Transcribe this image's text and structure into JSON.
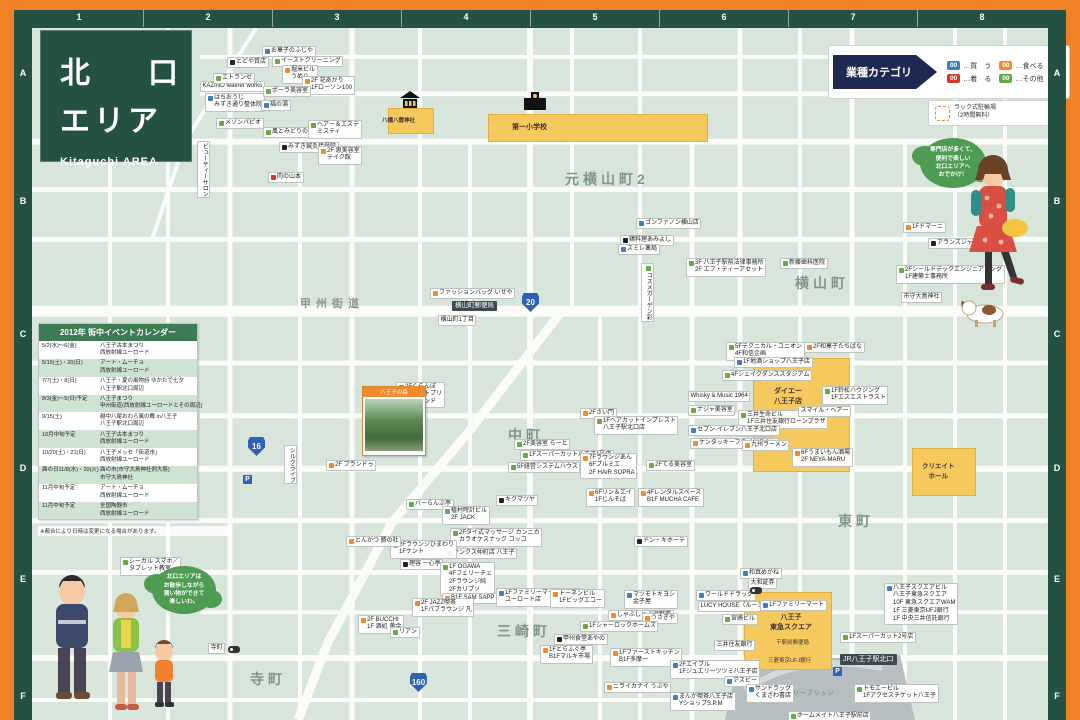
{
  "frame": {
    "columns": [
      "1",
      "2",
      "3",
      "4",
      "5",
      "6",
      "7",
      "8"
    ],
    "rows": [
      "A",
      "B",
      "C",
      "D",
      "E",
      "F"
    ]
  },
  "title": {
    "line1": "北　口",
    "line2": "エリア",
    "subtitle": "Kitaguchi AREA"
  },
  "legend": {
    "header": "業種カテゴリ",
    "items": [
      {
        "code": "00",
        "label": "…買　う",
        "color": "#3f7fc1"
      },
      {
        "code": "00",
        "label": "…食べる",
        "color": "#ef8a2e"
      },
      {
        "code": "00",
        "label": "…着　る",
        "color": "#cf3b2a"
      },
      {
        "code": "00",
        "label": "…その他",
        "color": "#67a944"
      }
    ],
    "parking_label": "ラック式駐輪場\n（2時間無料）"
  },
  "calendar": {
    "title": "2012年 街中イベントカレンダー",
    "rows": [
      {
        "d": "5/2(水)～6(金)",
        "e": "八王子古本まつり\n西放射線ユーロード"
      },
      {
        "d": "5/19(土)・20(日)",
        "e": "アート・ムーチョ\n西放射線ユーロード"
      },
      {
        "d": "7/7(土)・8(日)",
        "e": "八王子・夏の風物詩 ゆかたで七夕\n八王子駅北口周辺"
      },
      {
        "d": "8/3(金)～5(日)予定",
        "e": "八王子まつり\n甲州街道(西放射線ユーロードとその周辺)"
      },
      {
        "d": "9/15(土)",
        "e": "越中八尾おわら風の舞 in八王子\n八王子駅北口周辺"
      },
      {
        "d": "10月中旬予定",
        "e": "八王子古本まつり\n西放射線ユーロード"
      },
      {
        "d": "10/20(土)・21(日)",
        "e": "八王子メッセ「街道市」\n西放射線ユーロード"
      },
      {
        "d": "酉の日11/8(水)・20(火)",
        "e": "酉の市(市守大鳥神社例大祭)\n市守大鳥神社"
      },
      {
        "d": "11月中旬予定",
        "e": "アート・ムーチョ\n西放射線ユーロード"
      },
      {
        "d": "11月中旬予定",
        "e": "全国陶器市\n西放射線ユーロード"
      }
    ],
    "note": "※都合により日時は変更になる場合があります。"
  },
  "bubbles": {
    "right": "専門店が多くて、\n便利で楽しい\n北口エリアへ\nおでかけ！",
    "left": "北口エリアは\nお散歩しながら\n買い物ができて\n楽しいわ。"
  },
  "landmarks": {
    "shrine": "八幡八雲神社",
    "school": "第一小学校",
    "daiei": "ダイエー\n八王子店",
    "tokyu": "八王子\n東急スクエア",
    "post_office": "〒駅前郵便局",
    "ufj_bank": "三菱東京UFJ銀行",
    "create_hall": "クリエイト\nホール",
    "station": "JR八王子駅北口",
    "bridge": "マルベリーブリッジ",
    "photo_caption": "八王子の森"
  },
  "map": {
    "districts": [
      {
        "t": "元横山町2",
        "x": 565,
        "y": 168
      },
      {
        "t": "横山町",
        "x": 795,
        "y": 272
      },
      {
        "t": "中町",
        "x": 508,
        "y": 424
      },
      {
        "t": "東町",
        "x": 838,
        "y": 510
      },
      {
        "t": "三崎町",
        "x": 497,
        "y": 620
      },
      {
        "t": "寺町",
        "x": 250,
        "y": 668
      }
    ],
    "street_names": [
      {
        "t": "甲州街道",
        "x": 300,
        "y": 294
      }
    ],
    "routes": [
      {
        "n": "16",
        "x": 248,
        "y": 436
      },
      {
        "n": "20",
        "x": 522,
        "y": 292
      },
      {
        "n": "160",
        "x": 410,
        "y": 672
      }
    ],
    "parking_icons": [
      {
        "x": 243,
        "y": 474
      },
      {
        "x": 833,
        "y": 666
      }
    ],
    "bus_icons": [
      {
        "x": 228,
        "y": 645
      },
      {
        "x": 750,
        "y": 586
      }
    ],
    "labels": [
      {
        "t": "KAZINO leather works",
        "x": 200,
        "y": 80,
        "c": "p"
      },
      {
        "t": "はちおうじ\nみずき通り整体院",
        "x": 205,
        "y": 92,
        "c": "b"
      },
      {
        "t": "エトランゼ",
        "x": 213,
        "y": 72,
        "c": "g"
      },
      {
        "t": "とどや質店",
        "x": 227,
        "y": 56,
        "c": "k"
      },
      {
        "t": "お菓子のふじや",
        "x": 262,
        "y": 45,
        "c": "b"
      },
      {
        "t": "イーストクリーニング",
        "x": 272,
        "y": 55,
        "c": "g"
      },
      {
        "t": "堀米ビル\nうめ八",
        "x": 282,
        "y": 64,
        "c": "o"
      },
      {
        "t": "2F 花あかり\n1Fローソン100",
        "x": 302,
        "y": 75,
        "c": "o"
      },
      {
        "t": "ポーラ美容室",
        "x": 263,
        "y": 85,
        "c": "g"
      },
      {
        "t": "福の湯",
        "x": 261,
        "y": 99,
        "c": "b"
      },
      {
        "t": "風とみどりのマルシェ",
        "x": 263,
        "y": 126,
        "c": "g"
      },
      {
        "t": "ヘアー＆エステ\nミスティ",
        "x": 308,
        "y": 119,
        "c": "g"
      },
      {
        "t": "みずき鍼灸接骨院",
        "x": 279,
        "y": 141,
        "c": "k"
      },
      {
        "t": "2F 恵美容室\nテイク館",
        "x": 318,
        "y": 145,
        "c": "o"
      },
      {
        "t": "肉の山本",
        "x": 268,
        "y": 171,
        "c": "r"
      },
      {
        "t": "メゾンパピオ",
        "x": 216,
        "y": 117,
        "c": "g"
      },
      {
        "t": "ビューティーサロン",
        "x": 197,
        "y": 140,
        "c": "p",
        "v": 1
      },
      {
        "t": "ゴンファノン横山店",
        "x": 636,
        "y": 217,
        "c": "b"
      },
      {
        "t": "鶏料理あみよし",
        "x": 620,
        "y": 234,
        "c": "k"
      },
      {
        "t": "スミレ薬局",
        "x": 618,
        "y": 243,
        "c": "b"
      },
      {
        "t": "3F 八王子駅前法律事務所\n2F エフ・ティーアセット",
        "x": 686,
        "y": 257,
        "c": "g"
      },
      {
        "t": "新藤歯科医院",
        "x": 780,
        "y": 257,
        "c": "g"
      },
      {
        "t": "コスメガーデン彩",
        "x": 641,
        "y": 262,
        "c": "g",
        "v": 1
      },
      {
        "t": "ファッションバッグ いせや",
        "x": 430,
        "y": 287,
        "c": "o"
      },
      {
        "t": "横山町郵便局",
        "x": 452,
        "y": 300,
        "c": "badge"
      },
      {
        "t": "横山町1丁目",
        "x": 438,
        "y": 314,
        "c": "p"
      },
      {
        "t": "1Fドマーニ",
        "x": 903,
        "y": 221,
        "c": "o"
      },
      {
        "t": "アランズジャパン",
        "x": 928,
        "y": 237,
        "c": "k"
      },
      {
        "t": "2Fシールドテックエンジニアリング\n1F建築士事務所",
        "x": 896,
        "y": 264,
        "c": "g"
      },
      {
        "t": "市守大鳥神社",
        "x": 901,
        "y": 291,
        "c": "p"
      },
      {
        "t": "2Fくらんぼ\n2Fエイトプリ\n1Fセカンド",
        "x": 396,
        "y": 381,
        "c": "g"
      },
      {
        "t": "シルクライブ",
        "x": 284,
        "y": 444,
        "c": "p",
        "v": 1
      },
      {
        "t": "2F ブランドゥ",
        "x": 326,
        "y": 459,
        "c": "o"
      },
      {
        "t": "2Fさい門",
        "x": 580,
        "y": 407,
        "c": "o"
      },
      {
        "t": "1Fヘアカットインプレスト\n八王子駅北口店",
        "x": 594,
        "y": 415,
        "c": "g"
      },
      {
        "t": "2F美容室 らーと",
        "x": 514,
        "y": 438,
        "c": "g"
      },
      {
        "t": "1Fスーパーカット八王子1号店",
        "x": 520,
        "y": 449,
        "c": "g"
      },
      {
        "t": "5F経営システムハウス",
        "x": 508,
        "y": 461,
        "c": "g"
      },
      {
        "t": "7Fラウンジあん\n6Fプルミエ\n2F HAIR SOPRA",
        "x": 580,
        "y": 452,
        "c": "o"
      },
      {
        "t": "2Fてる美容室",
        "x": 646,
        "y": 459,
        "c": "g"
      },
      {
        "t": "6Fリン＆エイ\n1Fじんそば",
        "x": 586,
        "y": 487,
        "c": "o"
      },
      {
        "t": "4Fレンタルスペース\nB1F MUCHA CAFE",
        "x": 638,
        "y": 487,
        "c": "o"
      },
      {
        "t": "キクマツヤ",
        "x": 496,
        "y": 494,
        "c": "k"
      },
      {
        "t": "ドン・キホーテ",
        "x": 634,
        "y": 535,
        "c": "k"
      },
      {
        "t": "バーらんぶ亭",
        "x": 406,
        "y": 498,
        "c": "g"
      },
      {
        "t": "植村時計ビル\n2F JACK",
        "x": 442,
        "y": 505,
        "c": "g"
      },
      {
        "t": "2Fタイ式マッサージ カンニカ\nカラオケスナック コッコ",
        "x": 450,
        "y": 527,
        "c": "g"
      },
      {
        "t": "サンクス仲町店 八王子",
        "x": 444,
        "y": 547,
        "c": "k"
      },
      {
        "t": "2Fラウンジひまわり\n1Fケント",
        "x": 390,
        "y": 539,
        "c": "o"
      },
      {
        "t": "理容 一心亭",
        "x": 400,
        "y": 558,
        "c": "k"
      },
      {
        "t": "1F OGAWA\n4Fフェリーチェ\n2Fラウンジ純\n2Fカリプソ",
        "x": 440,
        "y": 561,
        "c": "g"
      },
      {
        "t": "B1F SAM SAPP II",
        "x": 442,
        "y": 592,
        "c": "o"
      },
      {
        "t": "とんかつ 勝の杜",
        "x": 346,
        "y": 535,
        "c": "o"
      },
      {
        "t": "2F JAZZ喫茶\n1Fパブラウンジ 凡",
        "x": 412,
        "y": 597,
        "c": "o"
      },
      {
        "t": "1Fファミリーマート八王子\nユーロード店",
        "x": 496,
        "y": 587,
        "c": "b"
      },
      {
        "t": "2F BUCCHI\n1F 酒処 黄金",
        "x": 358,
        "y": 614,
        "c": "o"
      },
      {
        "t": "リアン",
        "x": 390,
        "y": 626,
        "c": "g"
      },
      {
        "t": "トーネンビル\n1Fビッグエコー",
        "x": 550,
        "y": 588,
        "c": "o"
      },
      {
        "t": "マツモトキヨシ\n金子屋",
        "x": 624,
        "y": 589,
        "c": "b"
      },
      {
        "t": "しゃぶしゃぶ温野菜",
        "x": 608,
        "y": 609,
        "c": "o"
      },
      {
        "t": "うさぎや",
        "x": 642,
        "y": 612,
        "c": "o"
      },
      {
        "t": "1Fシャーロックホームズ",
        "x": 580,
        "y": 620,
        "c": "g"
      },
      {
        "t": "甲州食堂あやの",
        "x": 554,
        "y": 633,
        "c": "k"
      },
      {
        "t": "1Fとらふぐ亭\nB1Fマルキ市場",
        "x": 540,
        "y": 644,
        "c": "o"
      },
      {
        "t": "1Fファーストキッチン\nB1F多摩一",
        "x": 610,
        "y": 647,
        "c": "o"
      },
      {
        "t": "2Fエイブル\n1Fジュエリーツツミ八王子店",
        "x": 670,
        "y": 659,
        "c": "b"
      },
      {
        "t": "ニライカナイ うぶや",
        "x": 604,
        "y": 681,
        "c": "o"
      },
      {
        "t": "まんが喫茶八王子店\nYショップS.P.M",
        "x": 670,
        "y": 691,
        "c": "b"
      },
      {
        "t": "ワールドドラッグ",
        "x": 696,
        "y": 589,
        "c": "b"
      },
      {
        "t": "LUCY HOUSE（ルーシーハウス）",
        "x": 698,
        "y": 600,
        "c": "p"
      },
      {
        "t": "宮崎ビル",
        "x": 722,
        "y": 613,
        "c": "g"
      },
      {
        "t": "和真めがね",
        "x": 740,
        "y": 567,
        "c": "b"
      },
      {
        "t": "大和証券",
        "x": 748,
        "y": 577,
        "c": "p"
      },
      {
        "t": "1Fファミリーマート",
        "x": 760,
        "y": 599,
        "c": "b"
      },
      {
        "t": "三井住友銀行",
        "x": 714,
        "y": 639,
        "c": "p"
      },
      {
        "t": "アスビー",
        "x": 724,
        "y": 675,
        "c": "b"
      },
      {
        "t": "サンドラッグ\nくまざわ書店",
        "x": 746,
        "y": 683,
        "c": "b"
      },
      {
        "t": "1Fスーパーカット2号店",
        "x": 840,
        "y": 631,
        "c": "g"
      },
      {
        "t": "トモエービル\n1Fアクセスチケット八王子",
        "x": 854,
        "y": 683,
        "c": "g"
      },
      {
        "t": "ホームメイト八王子駅前店",
        "x": 788,
        "y": 710,
        "c": "g"
      },
      {
        "t": "八王子スクエアビル\n八王子東急スクエア\n10F 東急スクエアWAM\n1F 三菱東京UFJ銀行\n1F 中央三井信託銀行",
        "x": 884,
        "y": 582,
        "c": "b"
      },
      {
        "t": "5Fテクニカル・ユニオン\n4F和信企画",
        "x": 726,
        "y": 341,
        "c": "g"
      },
      {
        "t": "1F地酒ショップ八王子店",
        "x": 734,
        "y": 356,
        "c": "b"
      },
      {
        "t": "4Fシェイクダンススタジアム",
        "x": 722,
        "y": 369,
        "c": "g"
      },
      {
        "t": "Whisky & Music 1964",
        "x": 688,
        "y": 390,
        "c": "p"
      },
      {
        "t": "ナジャ美容室",
        "x": 688,
        "y": 404,
        "c": "g"
      },
      {
        "t": "三井生命ビル\n1F三井住友銀行ローンプラザ",
        "x": 738,
        "y": 409,
        "c": "g"
      },
      {
        "t": "1Fアース",
        "x": 736,
        "y": 425,
        "c": "g"
      },
      {
        "t": "セブン-イレブン八王子北口店",
        "x": 688,
        "y": 424,
        "c": "b"
      },
      {
        "t": "ケンタッキーフライドチキン",
        "x": 690,
        "y": 437,
        "c": "o"
      },
      {
        "t": "九州ラーメン",
        "x": 742,
        "y": 439,
        "c": "o"
      },
      {
        "t": "スマイル・ヘアー",
        "x": 798,
        "y": 405,
        "c": "p"
      },
      {
        "t": "1F鈴松ハウジング\n1Fエスエストラスト",
        "x": 822,
        "y": 385,
        "c": "g"
      },
      {
        "t": "2F和菓子たちばな",
        "x": 804,
        "y": 341,
        "c": "o"
      },
      {
        "t": "6Fうまいもん酒場\n2F NEYA-MARU",
        "x": 792,
        "y": 447,
        "c": "o"
      },
      {
        "t": "シーガル スマホ／\nタブレット教室",
        "x": 120,
        "y": 556,
        "c": "g"
      },
      {
        "t": "寺町",
        "x": 208,
        "y": 642,
        "c": "p"
      }
    ]
  }
}
